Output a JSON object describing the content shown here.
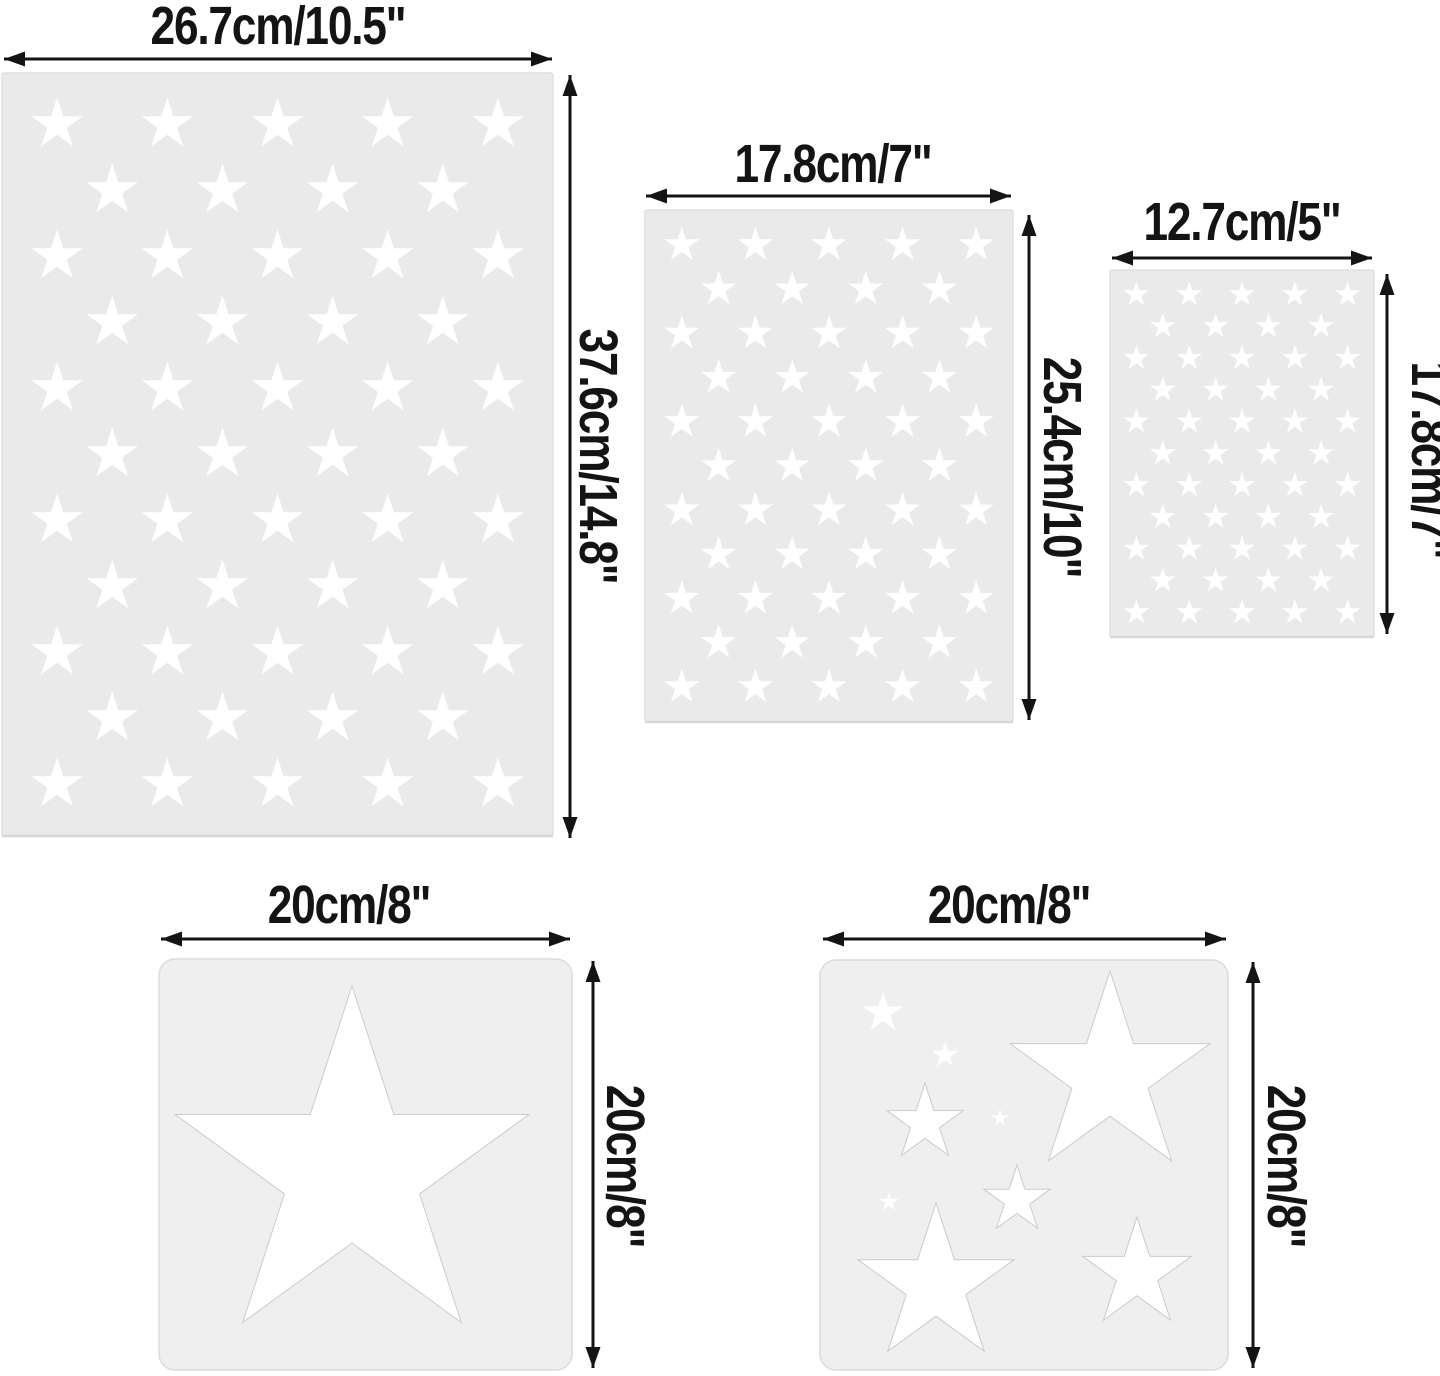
{
  "page": {
    "width": 1440,
    "height": 1376,
    "background": "#ffffff"
  },
  "colors": {
    "flag_stencil_fill": "#eaeaea",
    "flag_stencil_edge": "#e0e0e0",
    "flag_stencil_bottom_edge": "#d8d8d8",
    "square_stencil_fill": "#efefef",
    "square_stencil_edge": "#dcdcdc",
    "star_fill": "#ffffff",
    "big_star_stroke": "#cbcbcb",
    "arrow": "#141414",
    "text": "#141414"
  },
  "figures": [
    {
      "id": "flag-stencil-large",
      "type": "flag50",
      "width_label": "26.7cm/10.5\"",
      "height_label": "37.6cm/14.8\"",
      "rect": {
        "x": 2,
        "y": 73,
        "w": 551,
        "h": 763,
        "rx": 2
      },
      "grid": {
        "rows": 11,
        "cols": 5,
        "row_pitch": 66,
        "star_r": 27
      },
      "h_arrow": {
        "y": 59,
        "x1": 4,
        "x2": 552
      },
      "v_arrow": {
        "x": 570,
        "y1": 75,
        "y2": 838
      },
      "w_label_pos": {
        "cx": 278,
        "cy": 26
      },
      "h_label_pos": {
        "cx": 598,
        "cy": 456
      }
    },
    {
      "id": "flag-stencil-medium",
      "type": "flag50",
      "width_label": "17.8cm/7\"",
      "height_label": "25.4cm/10\"",
      "rect": {
        "x": 645,
        "y": 210,
        "w": 368,
        "h": 512,
        "rx": 2
      },
      "grid": {
        "rows": 11,
        "cols": 5,
        "row_pitch": 44.2,
        "star_r": 18.5
      },
      "h_arrow": {
        "y": 196,
        "x1": 646,
        "x2": 1011
      },
      "v_arrow": {
        "x": 1029,
        "y1": 215,
        "y2": 720
      },
      "w_label_pos": {
        "cx": 833,
        "cy": 164
      },
      "h_label_pos": {
        "cx": 1062,
        "cy": 467
      }
    },
    {
      "id": "flag-stencil-small",
      "type": "flag50",
      "width_label": "12.7cm/5\"",
      "height_label": "17.8cm/7\"",
      "rect": {
        "x": 1110,
        "y": 270,
        "w": 264,
        "h": 367,
        "rx": 2
      },
      "grid": {
        "rows": 11,
        "cols": 5,
        "row_pitch": 31.8,
        "star_r": 13.5
      },
      "h_arrow": {
        "y": 258,
        "x1": 1112,
        "x2": 1372
      },
      "v_arrow": {
        "x": 1387,
        "y1": 274,
        "y2": 634
      },
      "w_label_pos": {
        "cx": 1242,
        "cy": 222
      },
      "h_label_pos": {
        "cx": 1430,
        "cy": 460
      }
    },
    {
      "id": "single-star-stencil",
      "type": "stars",
      "width_label": "20cm/8\"",
      "height_label": "20cm/8\"",
      "rect": {
        "x": 159,
        "y": 959,
        "w": 413,
        "h": 411,
        "rx": 16
      },
      "stars": [
        {
          "cx": 352,
          "cy": 1172,
          "r": 186
        }
      ],
      "h_arrow": {
        "y": 939,
        "x1": 161,
        "x2": 570
      },
      "v_arrow": {
        "x": 593,
        "y1": 961,
        "y2": 1368
      },
      "w_label_pos": {
        "cx": 349,
        "cy": 905
      },
      "h_label_pos": {
        "cx": 625,
        "cy": 1166
      }
    },
    {
      "id": "multi-star-stencil",
      "type": "stars",
      "width_label": "20cm/8\"",
      "height_label": "20cm/8\"",
      "rect": {
        "x": 820,
        "y": 960,
        "w": 408,
        "h": 410,
        "rx": 16
      },
      "stars": [
        {
          "cx": 883,
          "cy": 1013,
          "r": 21
        },
        {
          "cx": 945,
          "cy": 1055,
          "r": 14
        },
        {
          "cx": 925,
          "cy": 1123,
          "r": 40
        },
        {
          "cx": 1000,
          "cy": 1118,
          "r": 9
        },
        {
          "cx": 1110,
          "cy": 1076,
          "r": 105
        },
        {
          "cx": 1017,
          "cy": 1200,
          "r": 35
        },
        {
          "cx": 889,
          "cy": 1202,
          "r": 10
        },
        {
          "cx": 936,
          "cy": 1285,
          "r": 82
        },
        {
          "cx": 1137,
          "cy": 1274,
          "r": 57
        }
      ],
      "h_arrow": {
        "y": 939,
        "x1": 823,
        "x2": 1226
      },
      "v_arrow": {
        "x": 1253,
        "y1": 962,
        "y2": 1368
      },
      "w_label_pos": {
        "cx": 1009,
        "cy": 905
      },
      "h_label_pos": {
        "cx": 1286,
        "cy": 1166
      }
    }
  ]
}
